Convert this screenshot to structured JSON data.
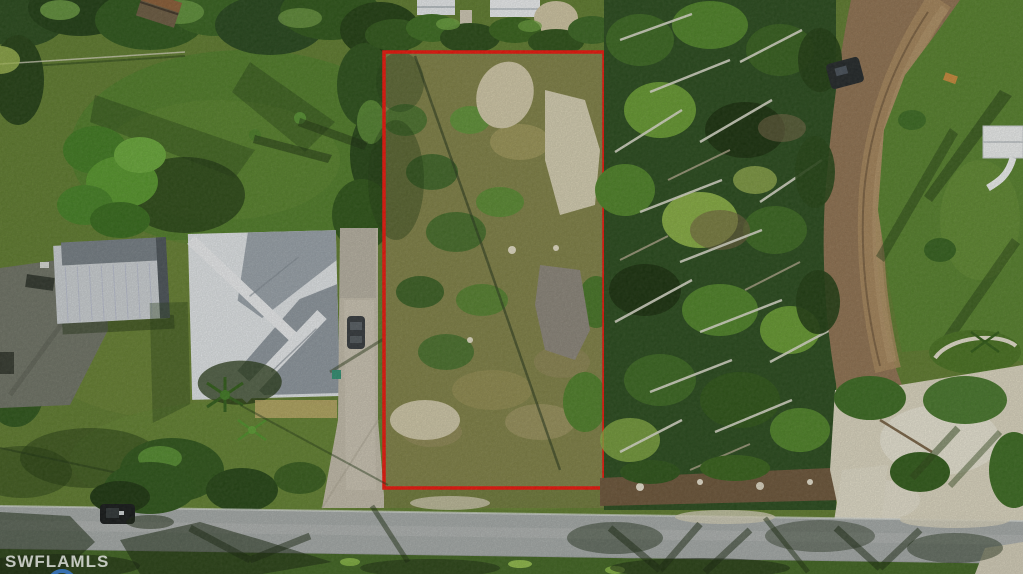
{
  "image": {
    "kind": "aerial-drone-photograph",
    "subject": "vacant overgrown land parcel outlined in red, bordered by a metal-roof home on the left, storm-damaged woods on the right, a dirt lane and a paved street",
    "watermark": "SWFLAMLS"
  },
  "colors": {
    "lot_outline_red": "#ee1309",
    "lawn_green": "#5e7b2d",
    "bright_lawn_green": "#4f7c27",
    "forest_green": "#27491b",
    "fallen_trunk_gray": "#dcdccd",
    "dirt_road_tan": "#8f7150",
    "paved_road_gray": "#a5aaa9",
    "sand_white": "#ddd7c1",
    "house_roof_white": "#e2e6e9",
    "house_roof_gray": "#99a2aa",
    "metal_building_gray": "#ccd1d5",
    "concrete_driveway": "#c3bcab",
    "shadow_dark": "#15240c",
    "watermark_white": "#ffffff",
    "logo_blue": "#3a78c9"
  }
}
